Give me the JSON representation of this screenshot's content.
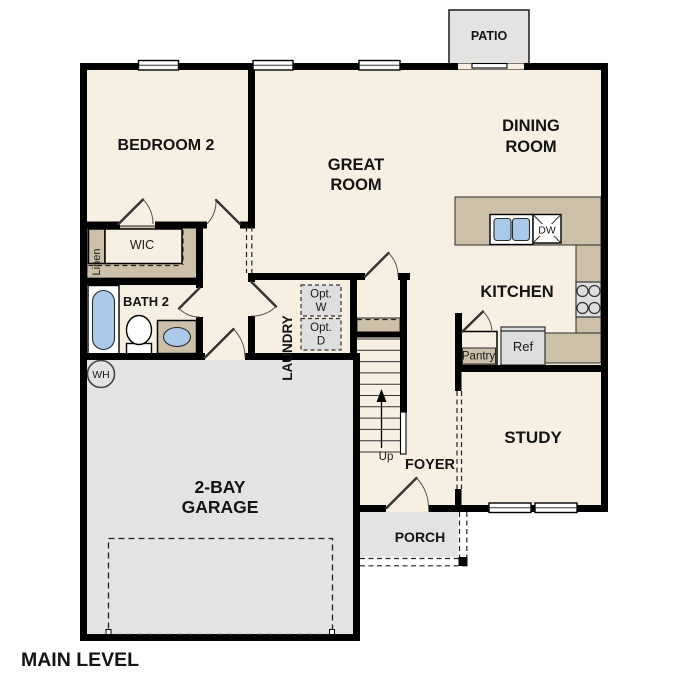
{
  "plan": {
    "title": "MAIN LEVEL",
    "rooms": {
      "bedroom2": "BEDROOM 2",
      "great_room": [
        "GREAT",
        "ROOM"
      ],
      "dining_room": [
        "DINING",
        "ROOM"
      ],
      "kitchen": "KITCHEN",
      "study": "STUDY",
      "foyer": "FOYER",
      "laundry": "LAUNDRY",
      "garage": [
        "2-BAY",
        "GARAGE"
      ],
      "porch": "PORCH",
      "patio": "PATIO",
      "bath2": "BATH 2",
      "wic": "WIC",
      "linen": "Linen"
    },
    "fixtures": {
      "pantry": "Pantry",
      "ref": "Ref",
      "dishwasher": "DW",
      "opt_washer": [
        "Opt.",
        "W"
      ],
      "opt_dryer": [
        "Opt.",
        "D"
      ],
      "water_heater": "WH",
      "stairs_up": "Up"
    },
    "colors": {
      "floor": "#f7efe2",
      "counter": "#ccc0a8",
      "slab": "#e4e3e1",
      "appliance": "#dedede",
      "fixture_blue": "#abc9e8",
      "wall": "#000000"
    }
  }
}
